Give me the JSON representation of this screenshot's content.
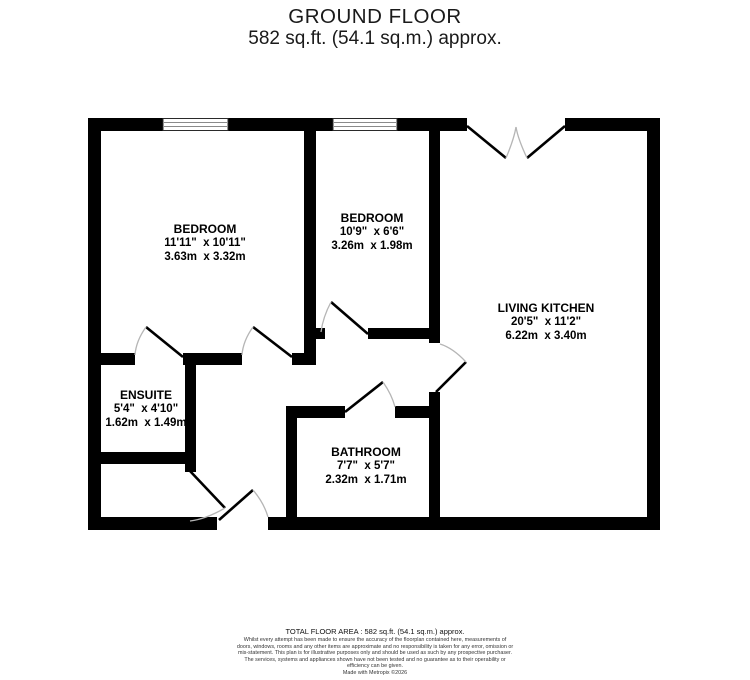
{
  "title": {
    "line1": "GROUND FLOOR",
    "line2": "582 sq.ft. (54.1 sq.m.) approx."
  },
  "rooms": {
    "bedroom1": {
      "name": "BEDROOM",
      "imperial": "11'11\"  x 10'11\"",
      "metric": "3.63m  x 3.32m"
    },
    "bedroom2": {
      "name": "BEDROOM",
      "imperial": "10'9\"  x 6'6\"",
      "metric": "3.26m  x 1.98m"
    },
    "living_kitchen": {
      "name": "LIVING KITCHEN",
      "imperial": "20'5\"  x 11'2\"",
      "metric": "6.22m  x 3.40m"
    },
    "ensuite": {
      "name": "ENSUITE",
      "imperial": "5'4\"  x 4'10\"",
      "metric": "1.62m  x 1.49m"
    },
    "bathroom": {
      "name": "BATHROOM",
      "imperial": "7'7\"  x 5'7\"",
      "metric": "2.32m  x 1.71m"
    }
  },
  "footer": {
    "total_area": "TOTAL FLOOR AREA : 582 sq.ft. (54.1 sq.m.) approx.",
    "disclaimer": "Whilst every attempt has been made to ensure the accuracy of the floorplan contained here, measurements of doors, windows, rooms and any other items are approximate and no responsibility is taken for any error, omission or mis-statement. This plan is for illustrative purposes only and should be used as such by any prospective purchaser. The services, systems and appliances shown have not been tested and no guarantee as to their operability or efficiency can be given.",
    "credit": "Made with Metropix ©2026"
  },
  "colors": {
    "wall": "#000000",
    "door_leaf": "#000000",
    "door_arc": "#b5b5b5",
    "window_frame": "#2a2a2a",
    "window_line": "#8a8a8a"
  }
}
